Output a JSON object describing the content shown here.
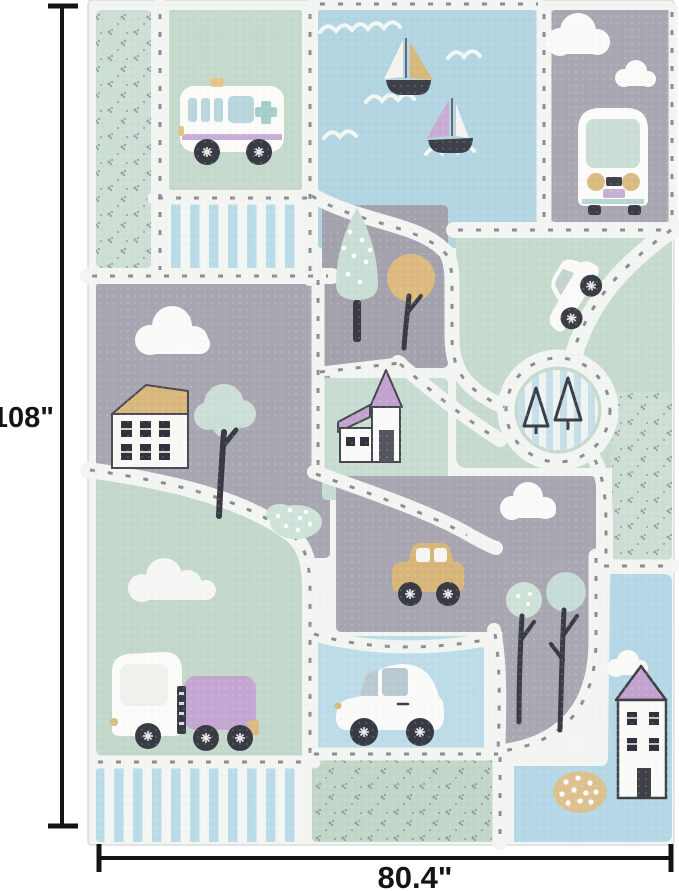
{
  "annotations": {
    "height_label": "108\"",
    "width_label": "80.4\""
  },
  "rug": {
    "palette": {
      "road_white": "#f3f5f2",
      "mint_green": "#c7dccf",
      "gray": "#a8a7b1",
      "water_blue": "#b3d5e2",
      "light_blue": "#bcdce8",
      "stripe_blue": "#badbe8",
      "purple": "#c4a7d2",
      "tan": "#d9b87c",
      "dark": "#3a3d45",
      "road_dash_gray": "#8d8c96",
      "dimension_line": "#141414"
    },
    "objects": [
      "ambulance",
      "sailboat-tan",
      "sailboat-purple",
      "waves",
      "bus-front",
      "clouds",
      "white-suv",
      "roundabout",
      "pine-trees",
      "house-tan-roof",
      "deciduous-tree",
      "conifer-tree",
      "round-tan-tree",
      "church",
      "mint-bush",
      "yellow-car",
      "truck",
      "white-car",
      "park-trees",
      "purple-roof-house",
      "tan-dotted-bush",
      "dotted-patches",
      "striped-patches"
    ]
  }
}
